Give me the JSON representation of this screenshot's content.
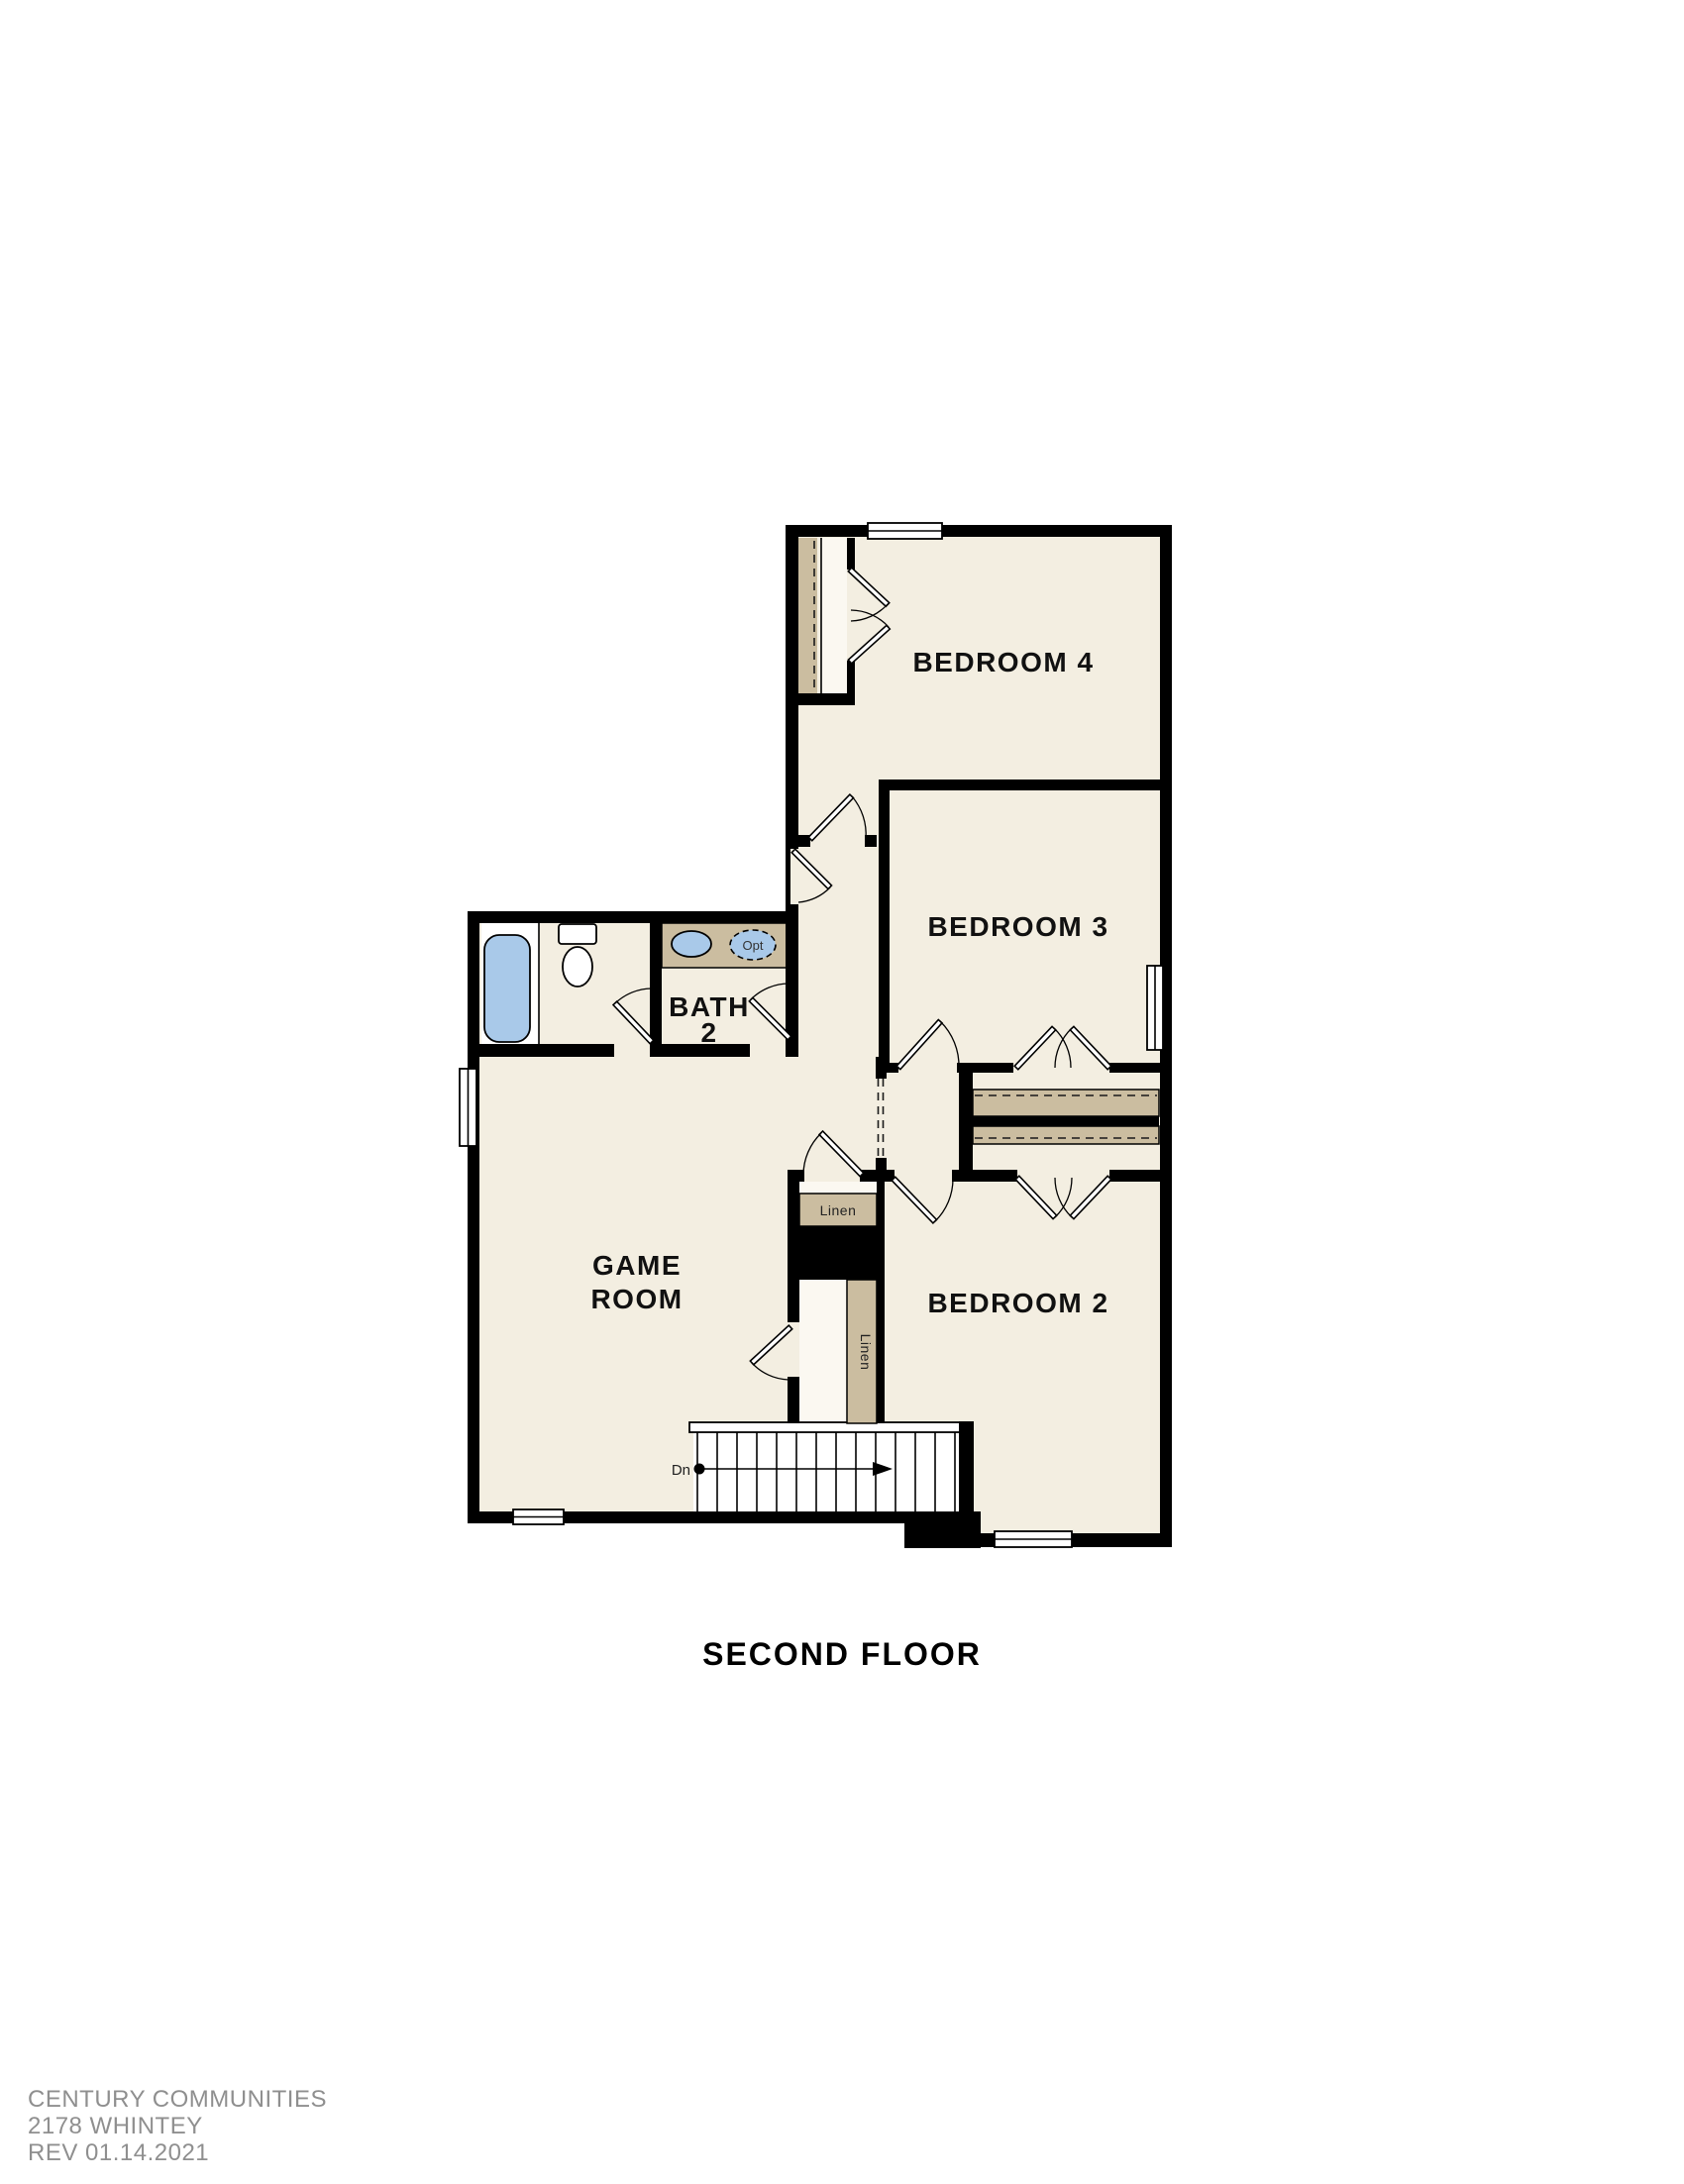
{
  "plan": {
    "sheet_title": "SECOND FLOOR",
    "rooms": {
      "bedroom4": "BEDROOM 4",
      "bedroom3": "BEDROOM 3",
      "bedroom2": "BEDROOM 2",
      "game_room_line1": "GAME",
      "game_room_line2": "ROOM",
      "bath_line1": "BATH",
      "bath_line2": "2"
    },
    "closets": {
      "linen_hall": "Linen",
      "linen_stairs": "Linen"
    },
    "fixtures": {
      "optional_sink_label": "Opt"
    },
    "stairs": {
      "direction_label": "Dn"
    }
  },
  "footer": {
    "builder": "CENTURY COMMUNITIES",
    "plan_number": "2178 WHINTEY",
    "revision": "REV 01.14.2021"
  },
  "colors": {
    "wall": "#000000",
    "floor": "#f3eee1",
    "casework_tan": "#cbbda0",
    "fixture_blue": "#a9c9e9",
    "footer_gray": "#8f8f8f",
    "label_black": "#111111"
  }
}
